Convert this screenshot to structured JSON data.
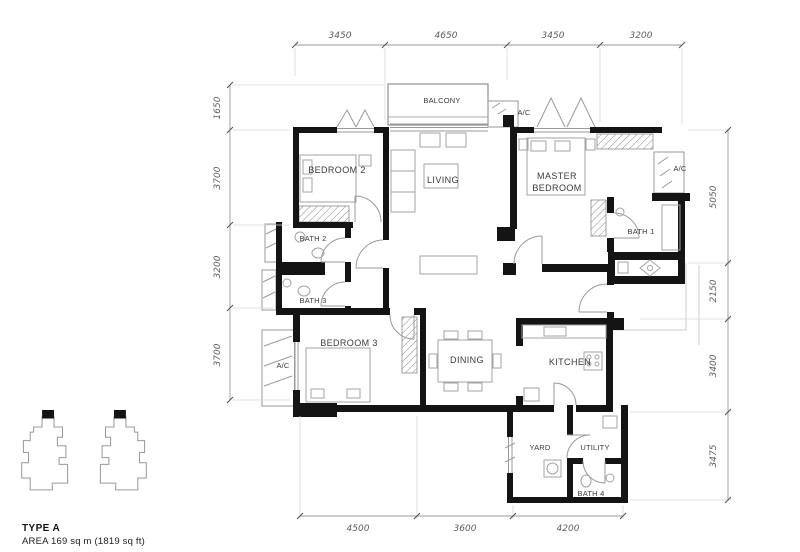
{
  "plan": {
    "rooms": {
      "balcony": "BALCONY",
      "living": "LIVING",
      "bedroom2": "BEDROOM 2",
      "master_line1": "MASTER",
      "master_line2": "BEDROOM",
      "bath1": "BATH 1",
      "bath2": "BATH 2",
      "bath3": "BATH 3",
      "bedroom3": "BEDROOM 3",
      "dining": "DINING",
      "kitchen": "KITCHEN",
      "yard": "YARD",
      "utility": "UTILITY",
      "bath4": "BATH 4",
      "ac_top": "A/C",
      "ac_right": "A/C",
      "ac_left": "A/C"
    },
    "dimensions_mm": {
      "top": [
        "3450",
        "4650",
        "3450",
        "3200"
      ],
      "bottom": [
        "4500",
        "3600",
        "4200"
      ],
      "left": [
        "1650",
        "3700",
        "3200",
        "3700"
      ],
      "right": [
        "5050",
        "2150",
        "3400",
        "3475"
      ]
    },
    "title": {
      "type": "TYPE A",
      "area": "AREA 169 sq m (1819 sq ft)"
    },
    "colors": {
      "walls": "#141414",
      "furniture_lines": "#9a9a9a",
      "dimension_text": "#5d5d5d",
      "label_text": "#3b3b3b"
    }
  }
}
